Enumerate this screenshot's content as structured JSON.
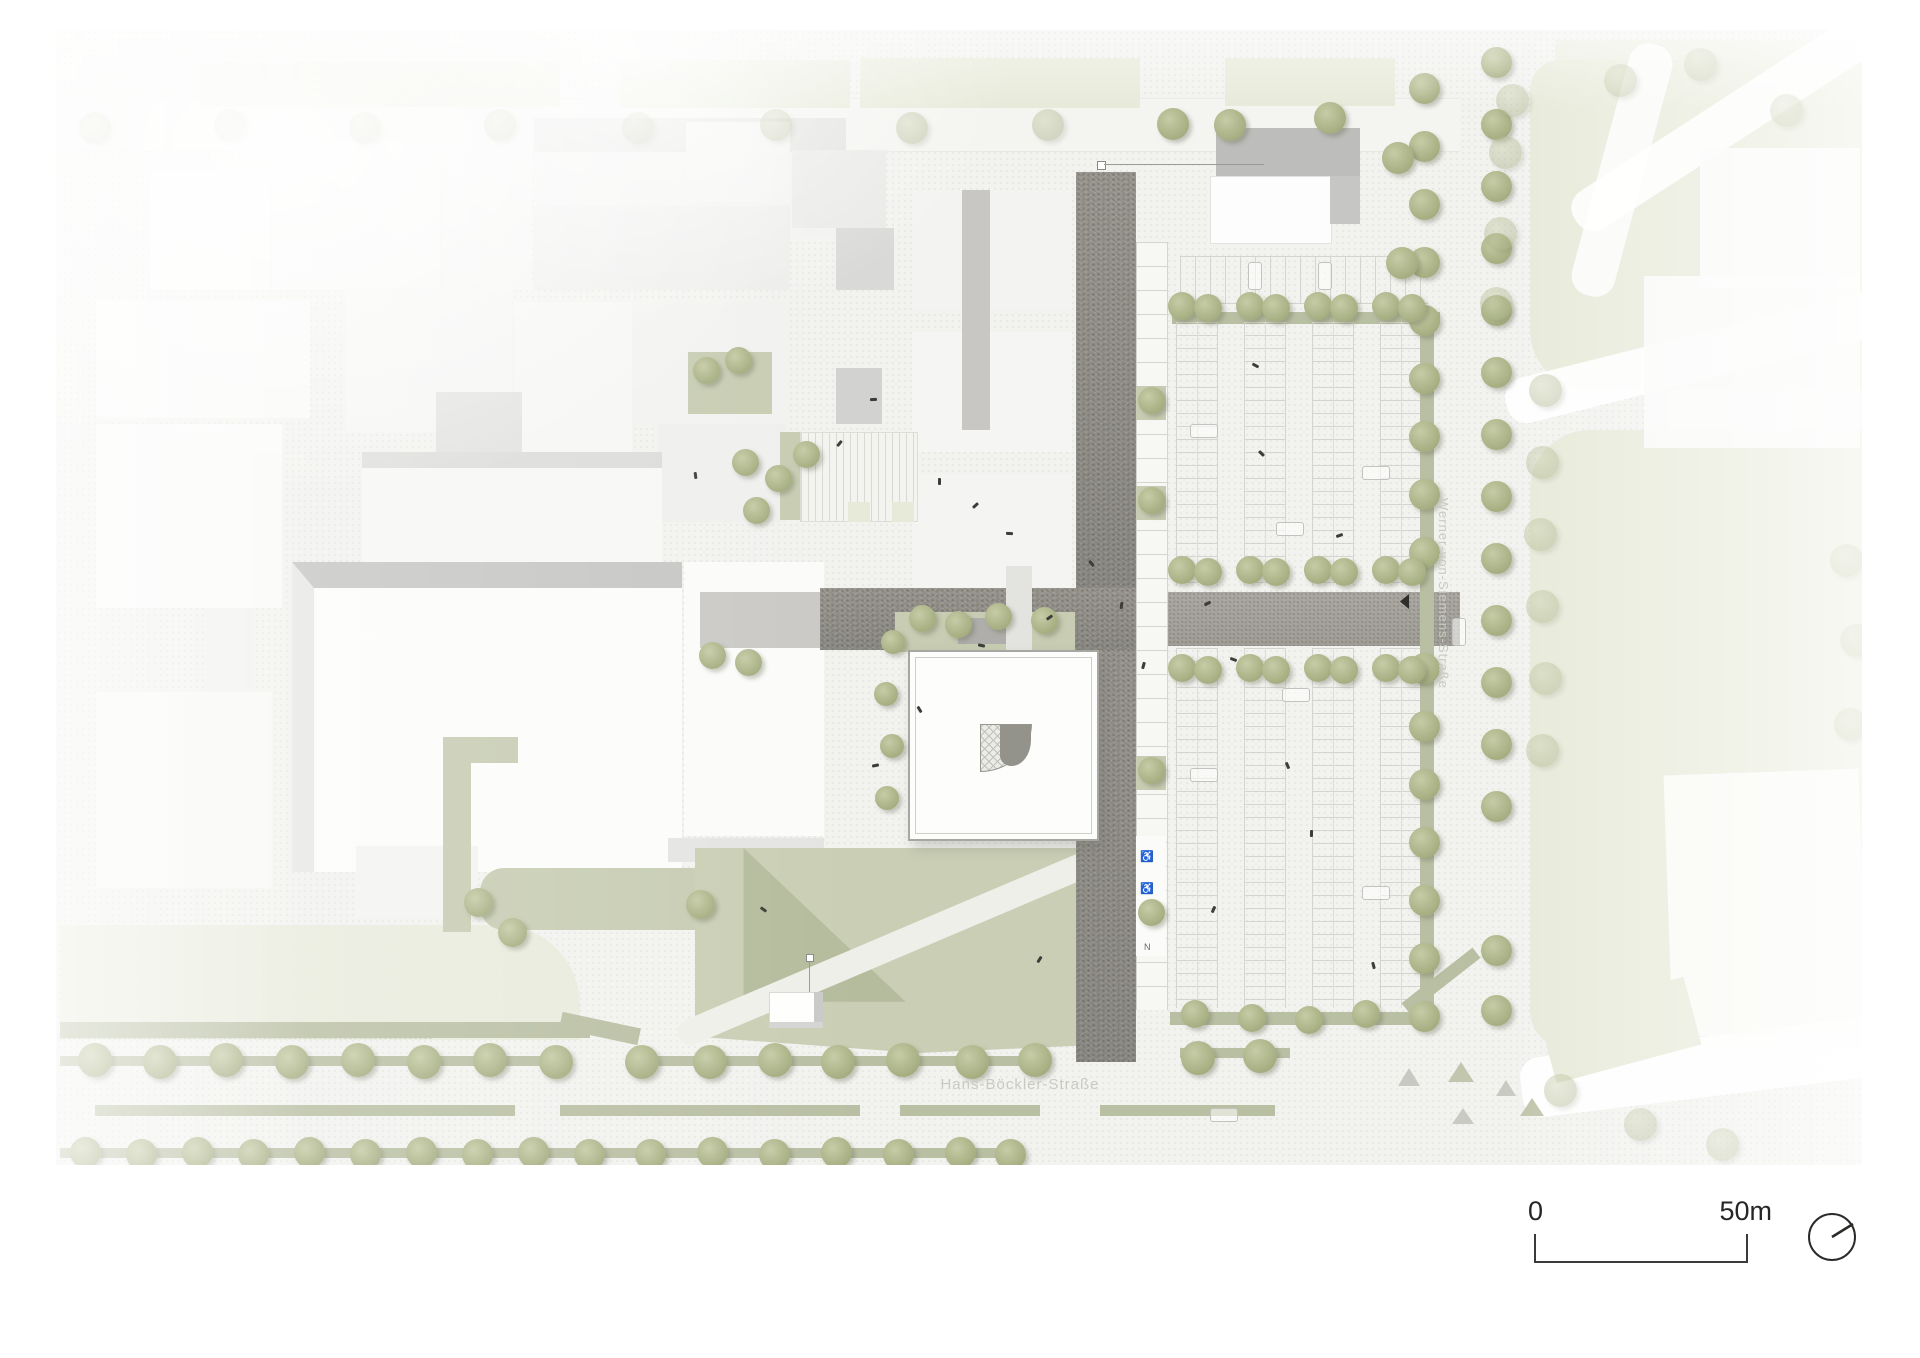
{
  "plan": {
    "type": "architectural-site-plan",
    "streets": {
      "bottom": "Hans-Böckler-Straße",
      "right": "Werner-von-Siemens-Straße"
    },
    "scale_bar": {
      "zero": "0",
      "end": "50m"
    },
    "symbols": {
      "accessible": "♿",
      "other": "N"
    },
    "icons": [
      "north-arrow-compass",
      "tree-icon",
      "person-icon",
      "car-icon"
    ],
    "colors": {
      "paper": "#ffffff",
      "ground": "#f2f2ef",
      "plaza_dark": "#8f8d87",
      "lawn": "#c7ccb2",
      "green_strip": "#b9bfa3",
      "faded_green": "#e7ead9",
      "building_white": "#fbfbf9",
      "tree": "#a9b185",
      "label_gray": "#c9c9c4",
      "ink": "#2a2a28"
    },
    "tree_groups": [
      {
        "name": "bottom-street-upper-row",
        "size": 34,
        "points": [
          [
            95,
            1060
          ],
          [
            160,
            1062
          ],
          [
            226,
            1060
          ],
          [
            292,
            1062
          ],
          [
            358,
            1060
          ],
          [
            424,
            1062
          ],
          [
            490,
            1060
          ],
          [
            556,
            1062
          ],
          [
            642,
            1062
          ],
          [
            710,
            1062
          ],
          [
            775,
            1060
          ],
          [
            838,
            1062
          ],
          [
            903,
            1060
          ],
          [
            972,
            1062
          ],
          [
            1035,
            1060
          ],
          [
            1198,
            1058
          ],
          [
            1260,
            1056
          ]
        ]
      },
      {
        "name": "bottom-street-lower-row",
        "size": 31,
        "points": [
          [
            85,
            1152
          ],
          [
            141,
            1154
          ],
          [
            197,
            1152
          ],
          [
            253,
            1154
          ],
          [
            309,
            1152
          ],
          [
            365,
            1154
          ],
          [
            421,
            1152
          ],
          [
            477,
            1154
          ],
          [
            533,
            1152
          ],
          [
            589,
            1154
          ],
          [
            650,
            1154
          ],
          [
            712,
            1152
          ],
          [
            774,
            1154
          ],
          [
            836,
            1152
          ],
          [
            898,
            1154
          ],
          [
            960,
            1152
          ],
          [
            1010,
            1154
          ]
        ]
      },
      {
        "name": "street-west-row",
        "size": 31,
        "points": [
          [
            1424,
            88
          ],
          [
            1424,
            146
          ],
          [
            1424,
            204
          ],
          [
            1424,
            262
          ],
          [
            1424,
            320
          ],
          [
            1424,
            378
          ],
          [
            1424,
            436
          ],
          [
            1424,
            494
          ],
          [
            1424,
            552
          ],
          [
            1424,
            668
          ],
          [
            1424,
            726
          ],
          [
            1424,
            784
          ],
          [
            1424,
            842
          ],
          [
            1424,
            900
          ],
          [
            1424,
            958
          ],
          [
            1424,
            1016
          ]
        ]
      },
      {
        "name": "street-east-row",
        "size": 31,
        "points": [
          [
            1496,
            62
          ],
          [
            1496,
            124
          ],
          [
            1496,
            186
          ],
          [
            1496,
            248
          ],
          [
            1496,
            310
          ],
          [
            1496,
            372
          ],
          [
            1496,
            434
          ],
          [
            1496,
            496
          ],
          [
            1496,
            558
          ],
          [
            1496,
            620
          ],
          [
            1496,
            682
          ],
          [
            1496,
            744
          ],
          [
            1496,
            806
          ],
          [
            1496,
            950
          ],
          [
            1496,
            1010
          ]
        ]
      },
      {
        "name": "parking-north-row",
        "size": 28,
        "points": [
          [
            1182,
            306
          ],
          [
            1208,
            308
          ],
          [
            1250,
            306
          ],
          [
            1276,
            308
          ],
          [
            1318,
            306
          ],
          [
            1344,
            308
          ],
          [
            1386,
            306
          ],
          [
            1412,
            308
          ]
        ]
      },
      {
        "name": "parking-axis-north-row",
        "size": 28,
        "points": [
          [
            1182,
            570
          ],
          [
            1208,
            572
          ],
          [
            1250,
            570
          ],
          [
            1276,
            572
          ],
          [
            1318,
            570
          ],
          [
            1344,
            572
          ],
          [
            1386,
            570
          ],
          [
            1412,
            572
          ]
        ]
      },
      {
        "name": "parking-axis-south-row",
        "size": 28,
        "points": [
          [
            1182,
            668
          ],
          [
            1208,
            670
          ],
          [
            1250,
            668
          ],
          [
            1276,
            670
          ],
          [
            1318,
            668
          ],
          [
            1344,
            670
          ],
          [
            1386,
            668
          ],
          [
            1412,
            670
          ]
        ]
      },
      {
        "name": "parking-south-row",
        "size": 28,
        "points": [
          [
            1195,
            1014
          ],
          [
            1252,
            1018
          ],
          [
            1309,
            1020
          ],
          [
            1366,
            1014
          ]
        ]
      },
      {
        "name": "parking-west-pads",
        "size": 27,
        "points": [
          [
            1151,
            400
          ],
          [
            1151,
            500
          ],
          [
            1151,
            770
          ],
          [
            1151,
            912
          ]
        ]
      },
      {
        "name": "plaza-trees",
        "size": 27,
        "points": [
          [
            745,
            462
          ],
          [
            778,
            478
          ],
          [
            806,
            454
          ],
          [
            756,
            510
          ],
          [
            706,
            370
          ],
          [
            738,
            360
          ],
          [
            922,
            618
          ],
          [
            958,
            624
          ],
          [
            998,
            616
          ],
          [
            1044,
            620
          ],
          [
            712,
            655
          ],
          [
            748,
            662
          ]
        ]
      },
      {
        "name": "building-edge-trees",
        "size": 24,
        "points": [
          [
            893,
            642
          ],
          [
            886,
            694
          ],
          [
            892,
            746
          ],
          [
            887,
            798
          ]
        ]
      },
      {
        "name": "lawn-trees",
        "size": 29,
        "points": [
          [
            700,
            904
          ],
          [
            478,
            902
          ],
          [
            512,
            932
          ]
        ]
      },
      {
        "name": "ne-corner-trees",
        "size": 32,
        "points": [
          [
            1173,
            124
          ],
          [
            1230,
            125
          ],
          [
            1330,
            118
          ],
          [
            1398,
            158
          ],
          [
            1402,
            263
          ]
        ]
      },
      {
        "name": "top-street-row",
        "size": 32,
        "style": "faded",
        "points": [
          [
            95,
            128
          ],
          [
            230,
            125
          ],
          [
            365,
            128
          ],
          [
            500,
            125
          ],
          [
            638,
            128
          ],
          [
            776,
            125
          ],
          [
            912,
            128
          ],
          [
            1048,
            125
          ]
        ]
      },
      {
        "name": "right-zone-trees",
        "size": 33,
        "style": "faded",
        "points": [
          [
            1512,
            100
          ],
          [
            1505,
            152
          ],
          [
            1500,
            233
          ],
          [
            1496,
            303
          ],
          [
            1545,
            390
          ],
          [
            1542,
            462
          ],
          [
            1540,
            534
          ],
          [
            1542,
            606
          ],
          [
            1545,
            678
          ],
          [
            1542,
            750
          ],
          [
            1560,
            1090
          ],
          [
            1640,
            1124
          ],
          [
            1722,
            1144
          ],
          [
            1846,
            560
          ],
          [
            1856,
            640
          ],
          [
            1850,
            724
          ],
          [
            1620,
            80
          ],
          [
            1700,
            64
          ],
          [
            1786,
            110
          ]
        ]
      }
    ],
    "people": [
      [
        938,
        478
      ],
      [
        974,
        502
      ],
      [
        1008,
        530
      ],
      [
        1090,
        560
      ],
      [
        1120,
        602
      ],
      [
        1048,
        614
      ],
      [
        980,
        642
      ],
      [
        918,
        706
      ],
      [
        1142,
        662
      ],
      [
        1206,
        600
      ],
      [
        1232,
        656
      ],
      [
        1286,
        762
      ],
      [
        1212,
        906
      ],
      [
        1338,
        532
      ],
      [
        1254,
        362
      ],
      [
        1372,
        962
      ],
      [
        1038,
        956
      ],
      [
        874,
        762
      ],
      [
        762,
        906
      ],
      [
        694,
        472
      ],
      [
        838,
        440
      ],
      [
        872,
        396
      ],
      [
        1260,
        450
      ],
      [
        1310,
        830
      ]
    ],
    "cars": [
      [
        1190,
        424,
        "h"
      ],
      [
        1276,
        522,
        "h"
      ],
      [
        1190,
        768,
        "h"
      ],
      [
        1362,
        466,
        "h"
      ],
      [
        1282,
        688,
        "h"
      ],
      [
        1362,
        886,
        "h"
      ],
      [
        1248,
        262,
        "v"
      ],
      [
        1318,
        262,
        "v"
      ],
      [
        1452,
        618,
        "v"
      ],
      [
        1210,
        1108,
        "h"
      ]
    ]
  }
}
